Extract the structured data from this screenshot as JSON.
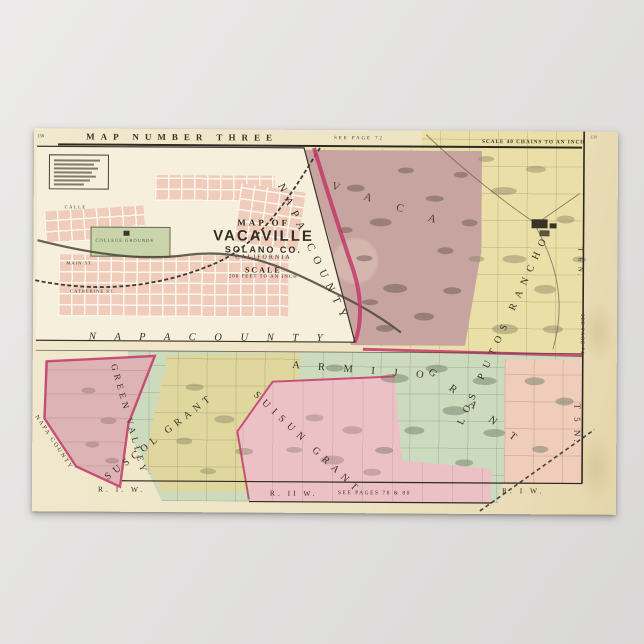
{
  "header": {
    "page_no_left": "138",
    "page_no_right": "139",
    "title": "MAP NUMBER THREE",
    "see_page_top": "SEE PAGE 72",
    "scale_right": "SCALE 40 CHAINS TO AN INCH"
  },
  "inset": {
    "title_line1": "MAP OF",
    "title_line2": "VACAVILLE",
    "title_line3": "SOLANO CO.",
    "title_line4": "CALIFORNIA",
    "scale_word": "SCALE",
    "scale_detail": "200 FEET TO AN INCH",
    "college_label": "COLLEGE GROUNDS",
    "street_main": "MAIN ST.",
    "street_catherine": "CATHERINE ST.",
    "street_calle": "CALLE"
  },
  "labels": {
    "napa_bottom": "N A P A     C O U N T Y",
    "napa_diag": "NAPA COUNTY",
    "napa_edge": "NAPA COUNTY",
    "vaca": "V A C A",
    "los_putos": "LOS  PUTOS  RANCHO",
    "armijo": "A R M I J O",
    "armijo_grant": "G R A N T",
    "suisun": "SUISUN  GRANT",
    "suscol": "SUSCOL  GRANT",
    "green_valley": "GREEN  VALLEY",
    "t5n": "T 5 N.",
    "t6n": "T 6 N.",
    "see_page_74": "SEE PAGE 74",
    "r1w_left": "R. I. W.",
    "r2w": "R. II W.",
    "see_pages_bottom": "SEE PAGES 78 & 80",
    "r1w_right": "R. I W."
  },
  "colors": {
    "background_gray": "#e2e1e0",
    "sheet_cream": "#eee4c4",
    "inset_panel": "#f5efdc",
    "vaca_brown": "#c7a49f",
    "los_putos_yellow": "#eadfa6",
    "armijo_green": "#ccdabe",
    "suisun_pink": "#ecc1c6",
    "suscol_olive": "#dfd79e",
    "green_valley_mauve": "#ddb3b3",
    "corner_pink": "#f0ccba",
    "county_line_magenta": "#c23a6b",
    "ink_black": "#3a3227"
  }
}
